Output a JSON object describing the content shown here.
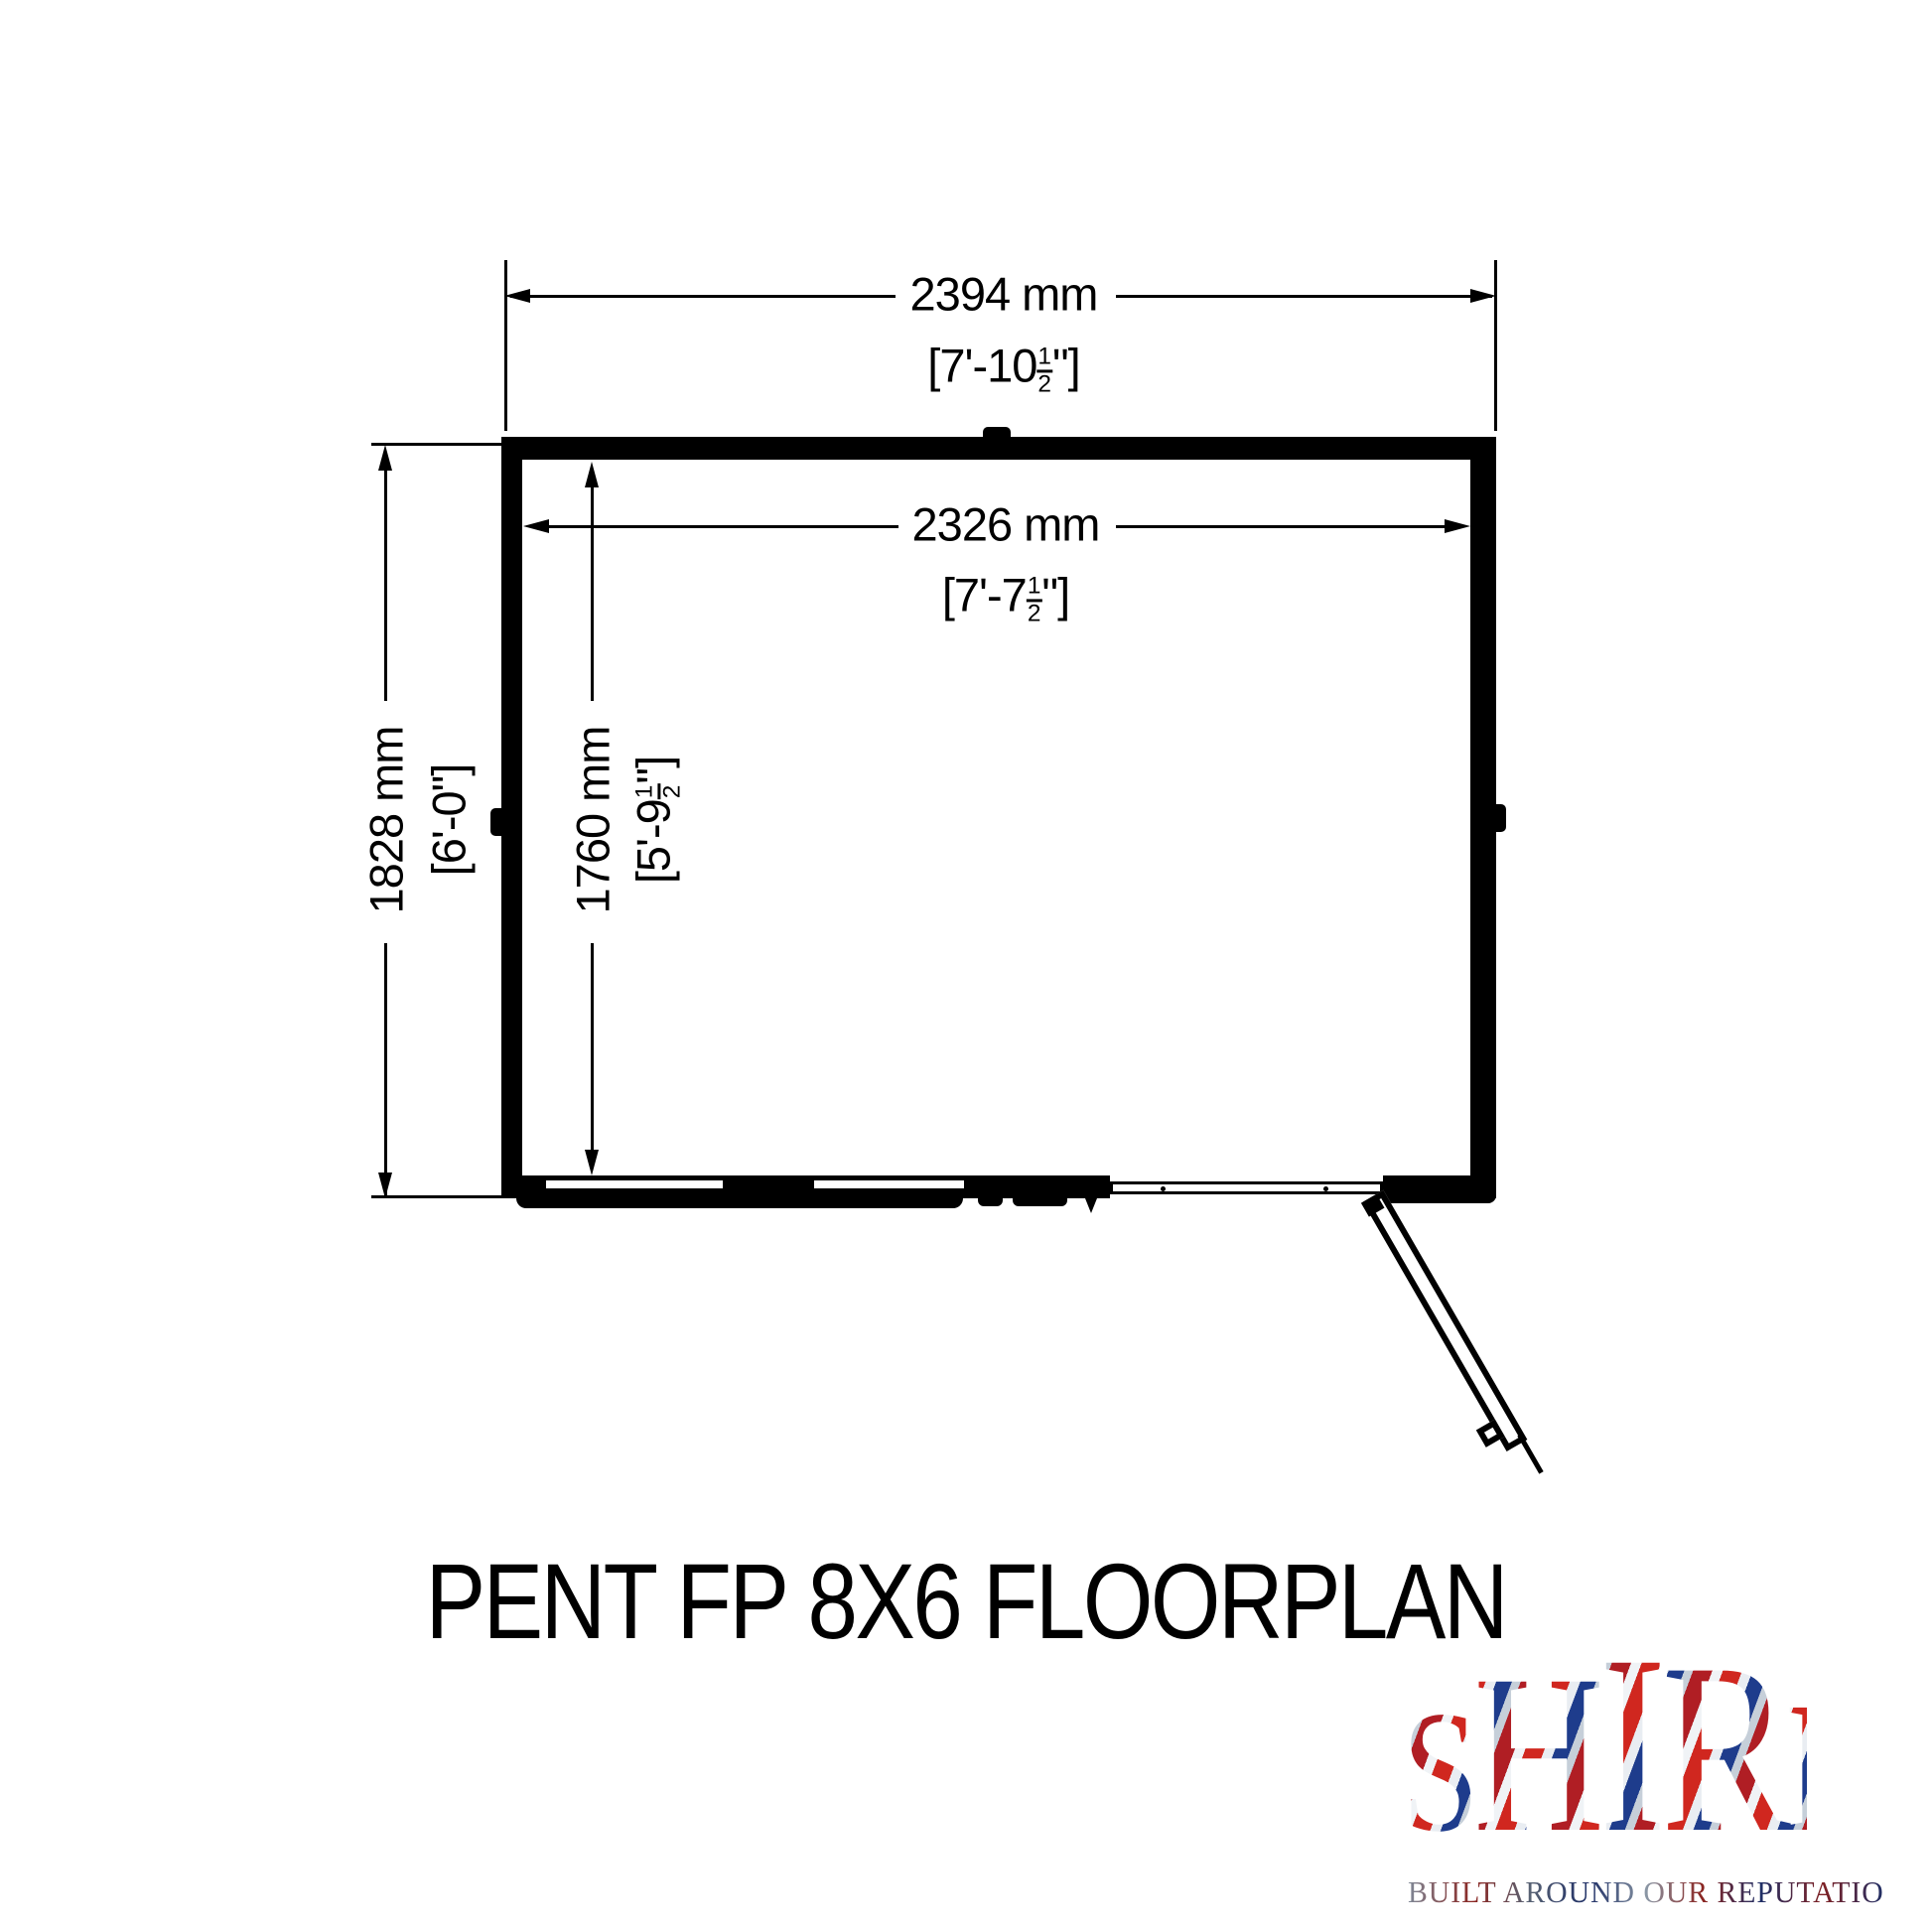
{
  "title": "PENT FP 8X6 FLOORPLAN",
  "dims": {
    "outer_w": {
      "mm": "2394 mm",
      "imp_pre": "[7'-10",
      "fn": "1",
      "fd": "2",
      "imp_post": "\"]"
    },
    "inner_w": {
      "mm": "2326 mm",
      "imp_pre": "[7'-7",
      "fn": "1",
      "fd": "2",
      "imp_post": "\"]"
    },
    "outer_h": {
      "mm": "1828 mm",
      "imp": "[6'-0\"]"
    },
    "inner_h": {
      "mm": "1760 mm",
      "imp_pre": "[5'-9",
      "fn": "1",
      "fd": "2",
      "imp_post": "\"]"
    }
  },
  "logo": {
    "letters": [
      "S",
      "H",
      "I",
      "R",
      "E"
    ],
    "tagline": "BUILT AROUND OUR REPUTATION"
  },
  "colors": {
    "ink": "#000000",
    "background": "#ffffff",
    "flag_red": "#d0271f",
    "flag_blue": "#1e3c8c",
    "flag_silver": "#e9edf2"
  }
}
